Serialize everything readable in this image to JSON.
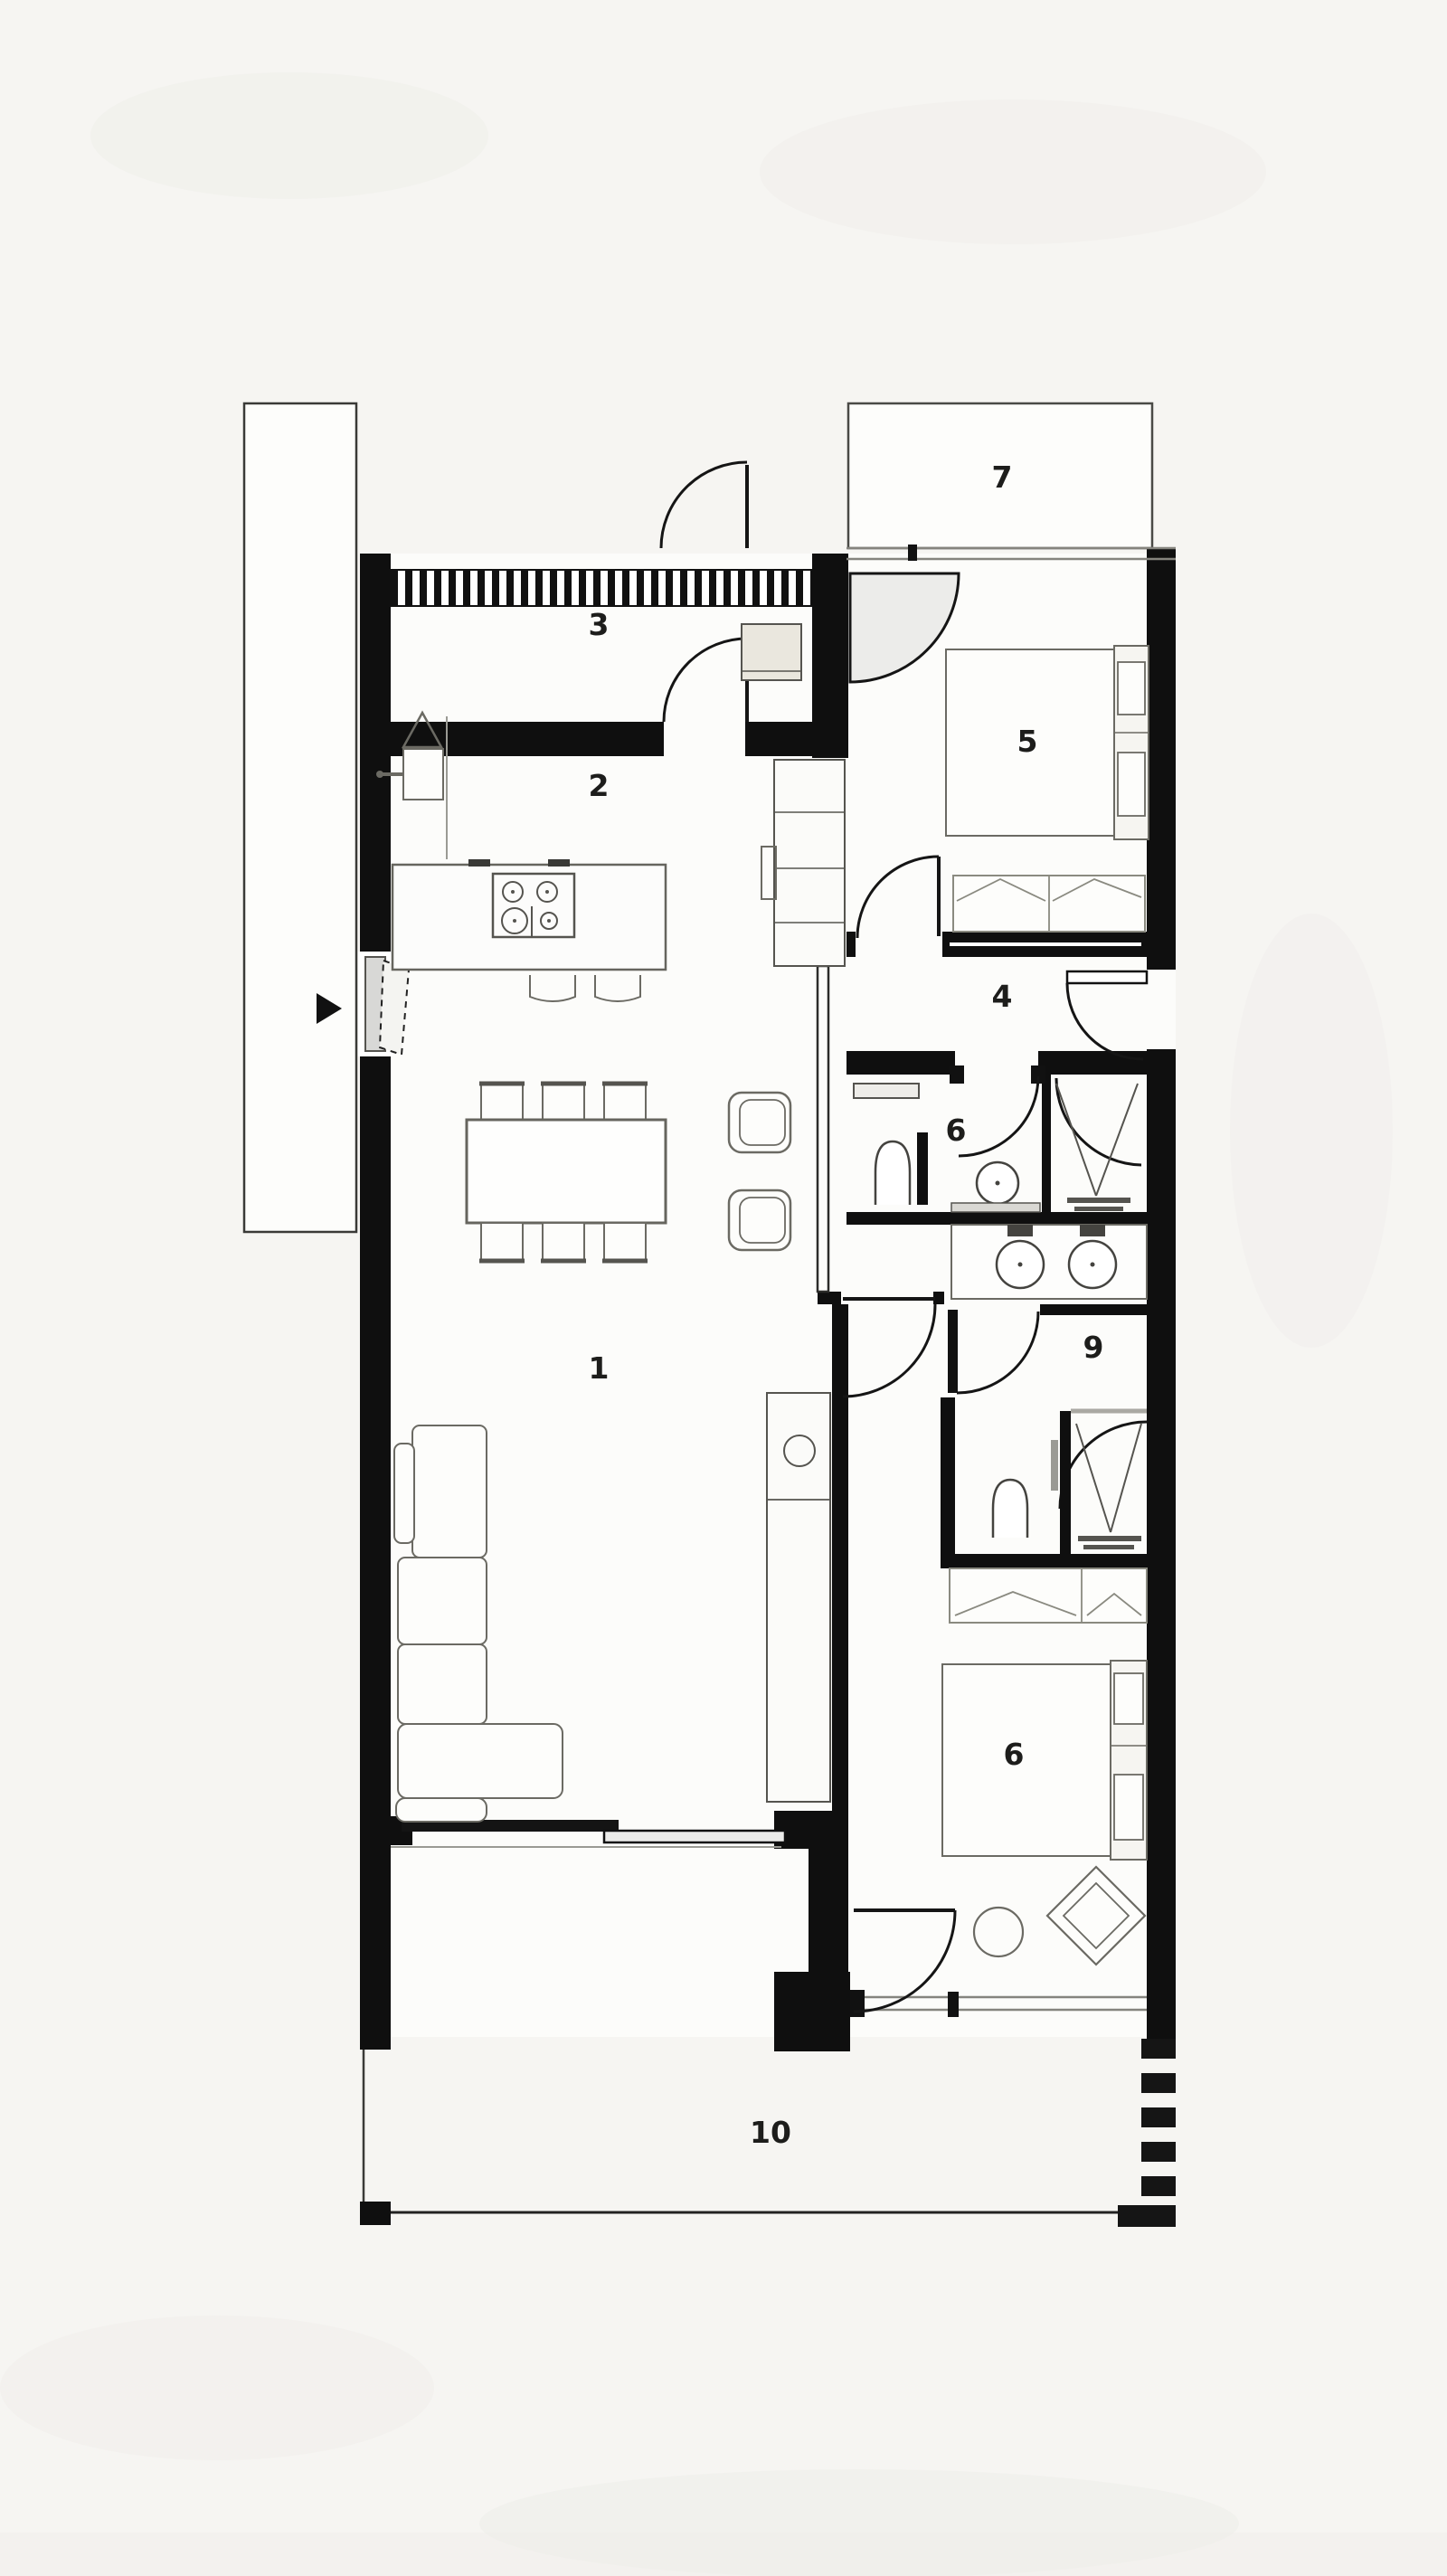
{
  "plan": {
    "type": "architectural-floor-plan",
    "rooms": [
      {
        "number": "1",
        "name": "living-dining-room"
      },
      {
        "number": "2",
        "name": "kitchen"
      },
      {
        "number": "3",
        "name": "entrance-hall"
      },
      {
        "number": "4",
        "name": "hallway"
      },
      {
        "number": "5",
        "name": "bedroom-1"
      },
      {
        "number": "6",
        "name": "wc-bathroom"
      },
      {
        "number": "7",
        "name": "upper-terrace"
      },
      {
        "number": "6",
        "name": "bedroom-2"
      },
      {
        "number": "9",
        "name": "ensuite-bathroom"
      },
      {
        "number": "10",
        "name": "lower-terrace"
      }
    ],
    "icons": [
      "entrance-arrow-icon",
      "door-swing-icon",
      "cooktop-burners-icon",
      "washbasin-icon",
      "toilet-icon",
      "shower-drain-icon"
    ],
    "colors": {
      "background": "#f6f5f2",
      "floor": "#fcfcfa",
      "wall": "#0f0f0f",
      "furniture_stroke": "#6b6a63",
      "furniture_fill": "#fdfdfb",
      "cabinet_beige": "#eae7de",
      "glass_gray": "#d8d8d6",
      "window_line": "#85847e",
      "label_text": "#1d1d1b"
    }
  }
}
